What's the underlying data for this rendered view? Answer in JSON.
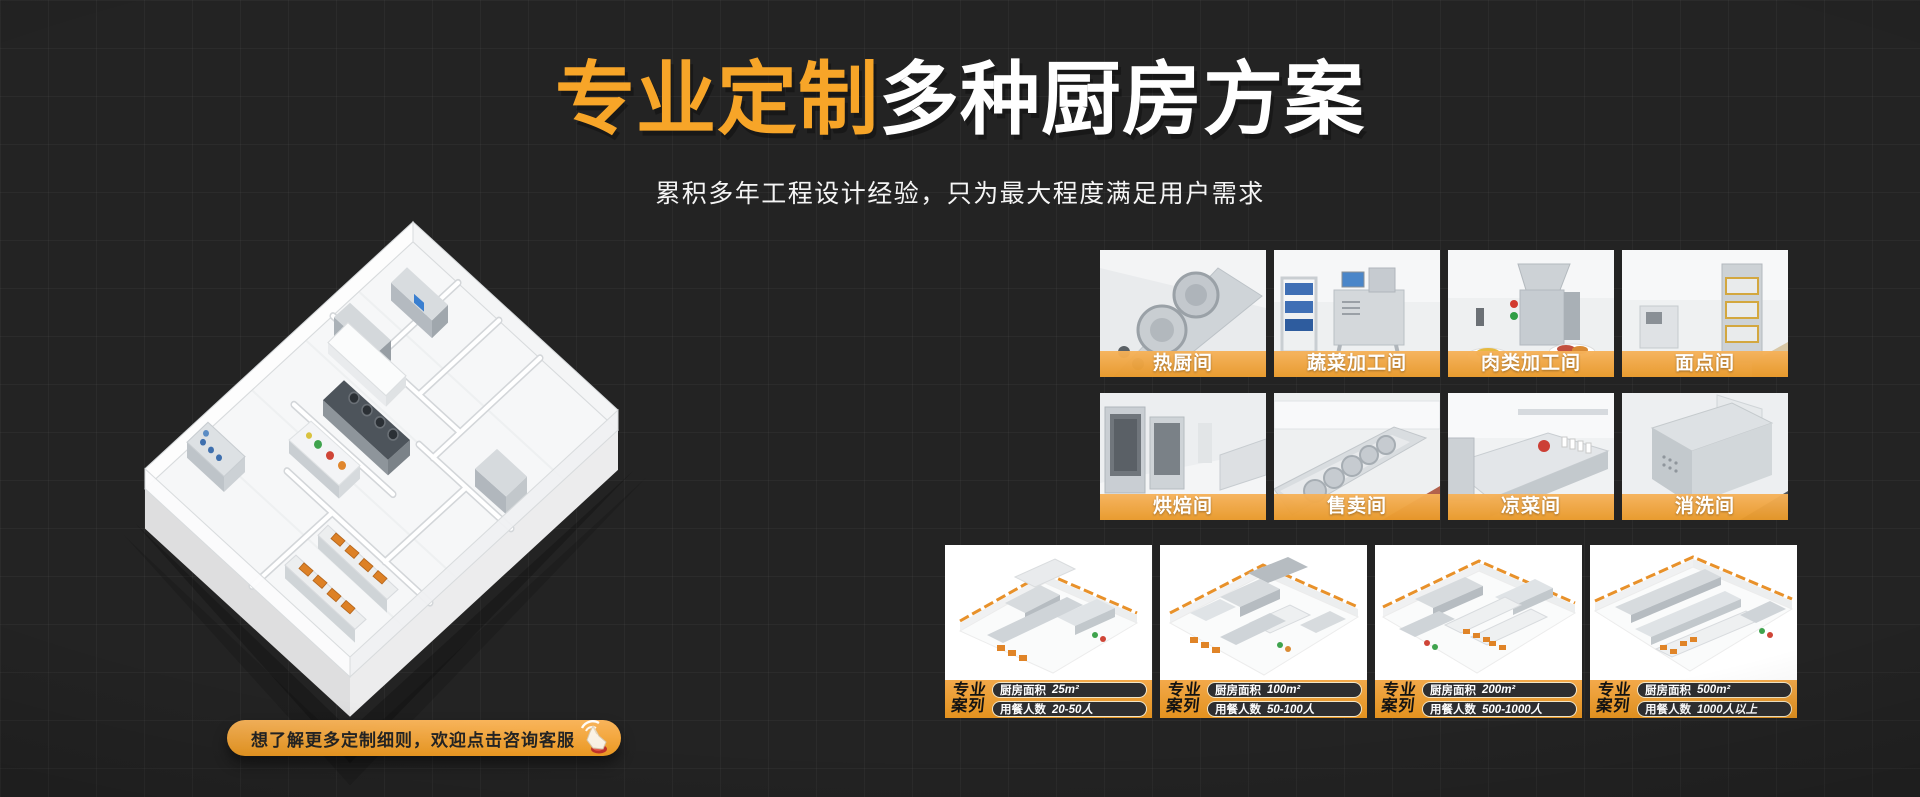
{
  "hero": {
    "title_highlight": "专业定制",
    "title_rest": "多种厨房方案",
    "subtitle": "累积多年工程设计经验，只为最大程度满足用户需求"
  },
  "rooms": {
    "items": [
      {
        "label": "热厨间"
      },
      {
        "label": "蔬菜加工间"
      },
      {
        "label": "肉类加工间"
      },
      {
        "label": "面点间"
      },
      {
        "label": "烘焙间"
      },
      {
        "label": "售卖间"
      },
      {
        "label": "凉菜间"
      },
      {
        "label": "消洗间"
      }
    ]
  },
  "cases": {
    "badge_line1": "专业",
    "badge_line2": "案列",
    "area_label": "厨房面积",
    "diners_label": "用餐人数",
    "items": [
      {
        "area": "25m²",
        "diners": "20-50人"
      },
      {
        "area": "100m²",
        "diners": "50-100人"
      },
      {
        "area": "200m²",
        "diners": "500-1000人"
      },
      {
        "area": "500m²",
        "diners": "1000人以上"
      }
    ]
  },
  "cta": {
    "label": "想了解更多定制细则，欢迎点击咨询客服"
  },
  "icons": {
    "cta": "hand-click-icon"
  },
  "colors": {
    "background": "#232323",
    "title_orange": "#F7A528",
    "label_gradient_top": "#F6B25A",
    "label_gradient_bottom": "#E89828",
    "case_bar_orange": "#ED9F32",
    "pill_dark": "#2E2E30"
  }
}
